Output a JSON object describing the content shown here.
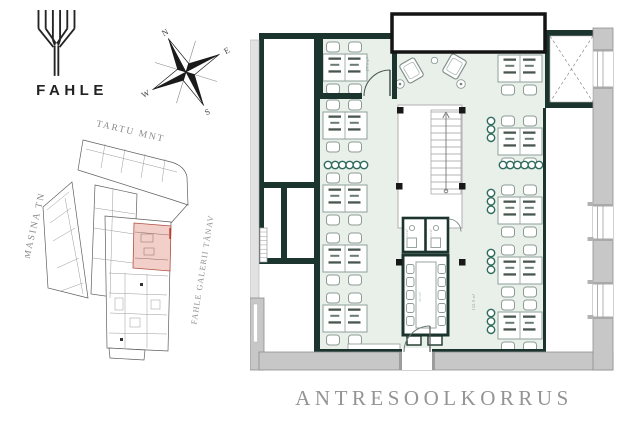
{
  "branding": {
    "name": "FAHLE"
  },
  "icons": {
    "logo_mark": "fahle-tree-logo",
    "compass": "compass-rose"
  },
  "compass": {
    "north": "N",
    "east": "E",
    "south": "S",
    "west": "W"
  },
  "site_plan": {
    "streets": [
      {
        "id": "tartu-mnt",
        "label": "TARTU MNT"
      },
      {
        "id": "masina-tn",
        "label": "MASINA TN"
      },
      {
        "id": "fahle-galerii-tanav",
        "label": "FAHLE GALERII TÄNAV"
      }
    ]
  },
  "floor_plan": {
    "title": "ANTRESOOLKORRUS",
    "area_labels": {
      "office_room": "27.0 m²",
      "open_space": "152.9 m²",
      "meeting_room": "13.1 m²",
      "booth_1": "3.3 m²",
      "booth_2": "3.3 m²"
    }
  },
  "colors": {
    "wall_dark": "#1c342e",
    "floor_green": "#e9efe9",
    "accent_green": "#2e6b5c",
    "wall_gray": "#c7c7c7",
    "highlight_pink": "#f2cfc9",
    "highlight_red": "#b25043",
    "title_gray": "#949494"
  }
}
